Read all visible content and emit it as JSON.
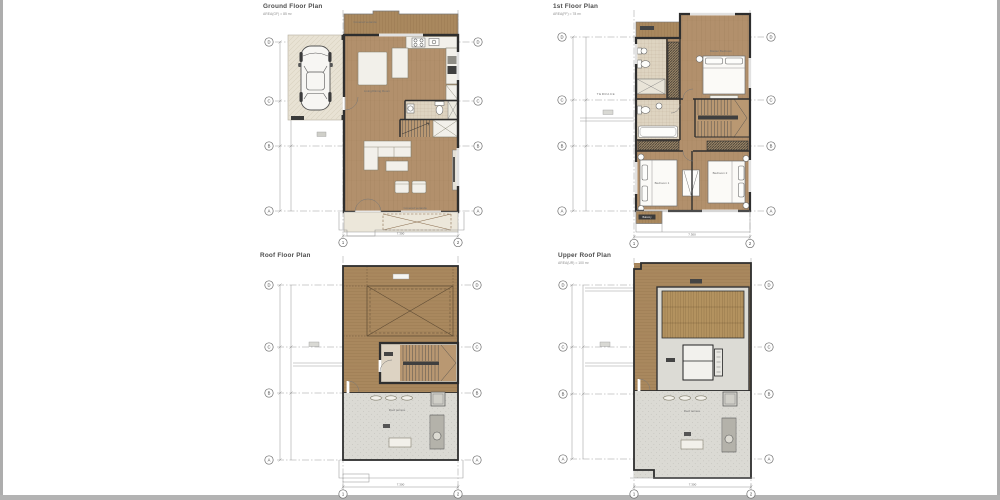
{
  "sheet": {
    "background": "#ffffff",
    "edge_color": "#adadad"
  },
  "grid": {
    "rows": [
      "D",
      "C",
      "B",
      "A"
    ],
    "cols": [
      "1",
      "2"
    ]
  },
  "dims": {
    "overall_width": "7.300"
  },
  "colors": {
    "wood_floor": "#b2906c",
    "wood_deck": "#a9885e",
    "pergola_slat": "#b3925f",
    "terrace_gray": "#dbdad4",
    "garage_beige": "#e8e2d4",
    "tile_beige": "#ded4c1",
    "wall": "#2e2e2e",
    "stair_wood": "#b99872"
  },
  "plans": {
    "ground": {
      "title": "Ground Floor Plan",
      "area": "AREA(GF) = 85 m²",
      "labels": {
        "veranda_top": "Covered veranda",
        "living": "Living/Dining Room",
        "veranda_bottom": "Covered veranda"
      }
    },
    "first": {
      "title": "1st Floor Plan",
      "area": "AREA(FF) = 78 m²",
      "labels": {
        "terrace": "TERRACE",
        "master": "Master Bedroom",
        "bedroom1": "Bedroom 1",
        "bedroom2": "Bedroom 2",
        "balcony": "Balcony"
      }
    },
    "roof": {
      "title": "Roof Floor Plan",
      "labels": {
        "terrace": "Roof terrace"
      }
    },
    "upper": {
      "title": "Upper Roof Plan",
      "area": "AREA(UR) = 100 m²",
      "labels": {
        "terrace": "Roof terrace"
      }
    }
  }
}
